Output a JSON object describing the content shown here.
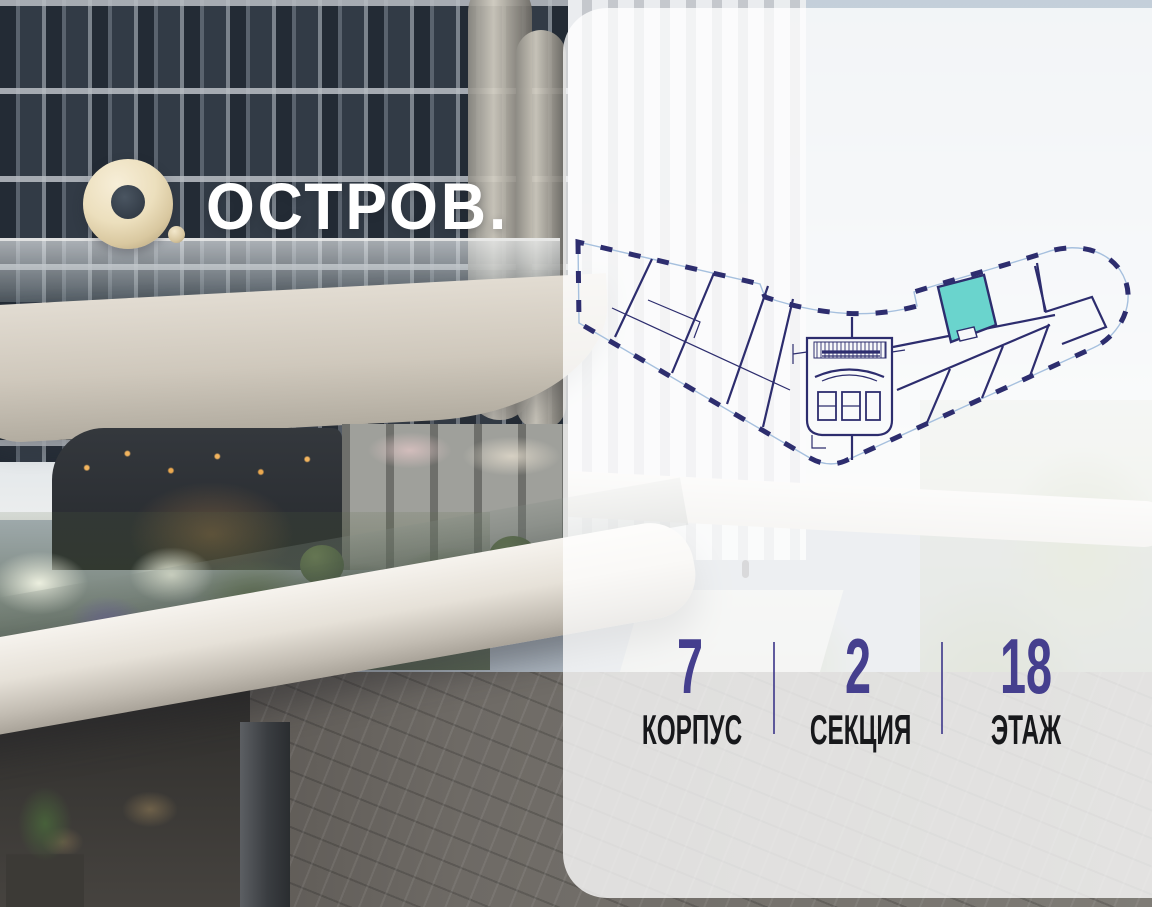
{
  "brand": {
    "wordmark": "ОСТРОВ.",
    "logo_icon": "gold-ring-with-dot"
  },
  "floorplan": {
    "name": "floor-plan-building-outline",
    "highlighted_unit": "selected-apartment",
    "shape": "boomerang-shaped floor with central elevator core and rounded right wing"
  },
  "stats": {
    "items": [
      {
        "value": "7",
        "label": "КОРПУС"
      },
      {
        "value": "2",
        "label": "СЕКЦИЯ"
      },
      {
        "value": "18",
        "label": "ЭТАЖ"
      }
    ]
  },
  "theme": {
    "accent_purple": "#453f8e",
    "label_black": "#17181b",
    "plan_navy": "#2d2d6e",
    "plan_lightblue": "#a6c0de",
    "unit_teal": "#6ad4cd",
    "logo_gold": "#e3d4b0",
    "panel_white": "rgba(255,255,255,0.78)"
  }
}
